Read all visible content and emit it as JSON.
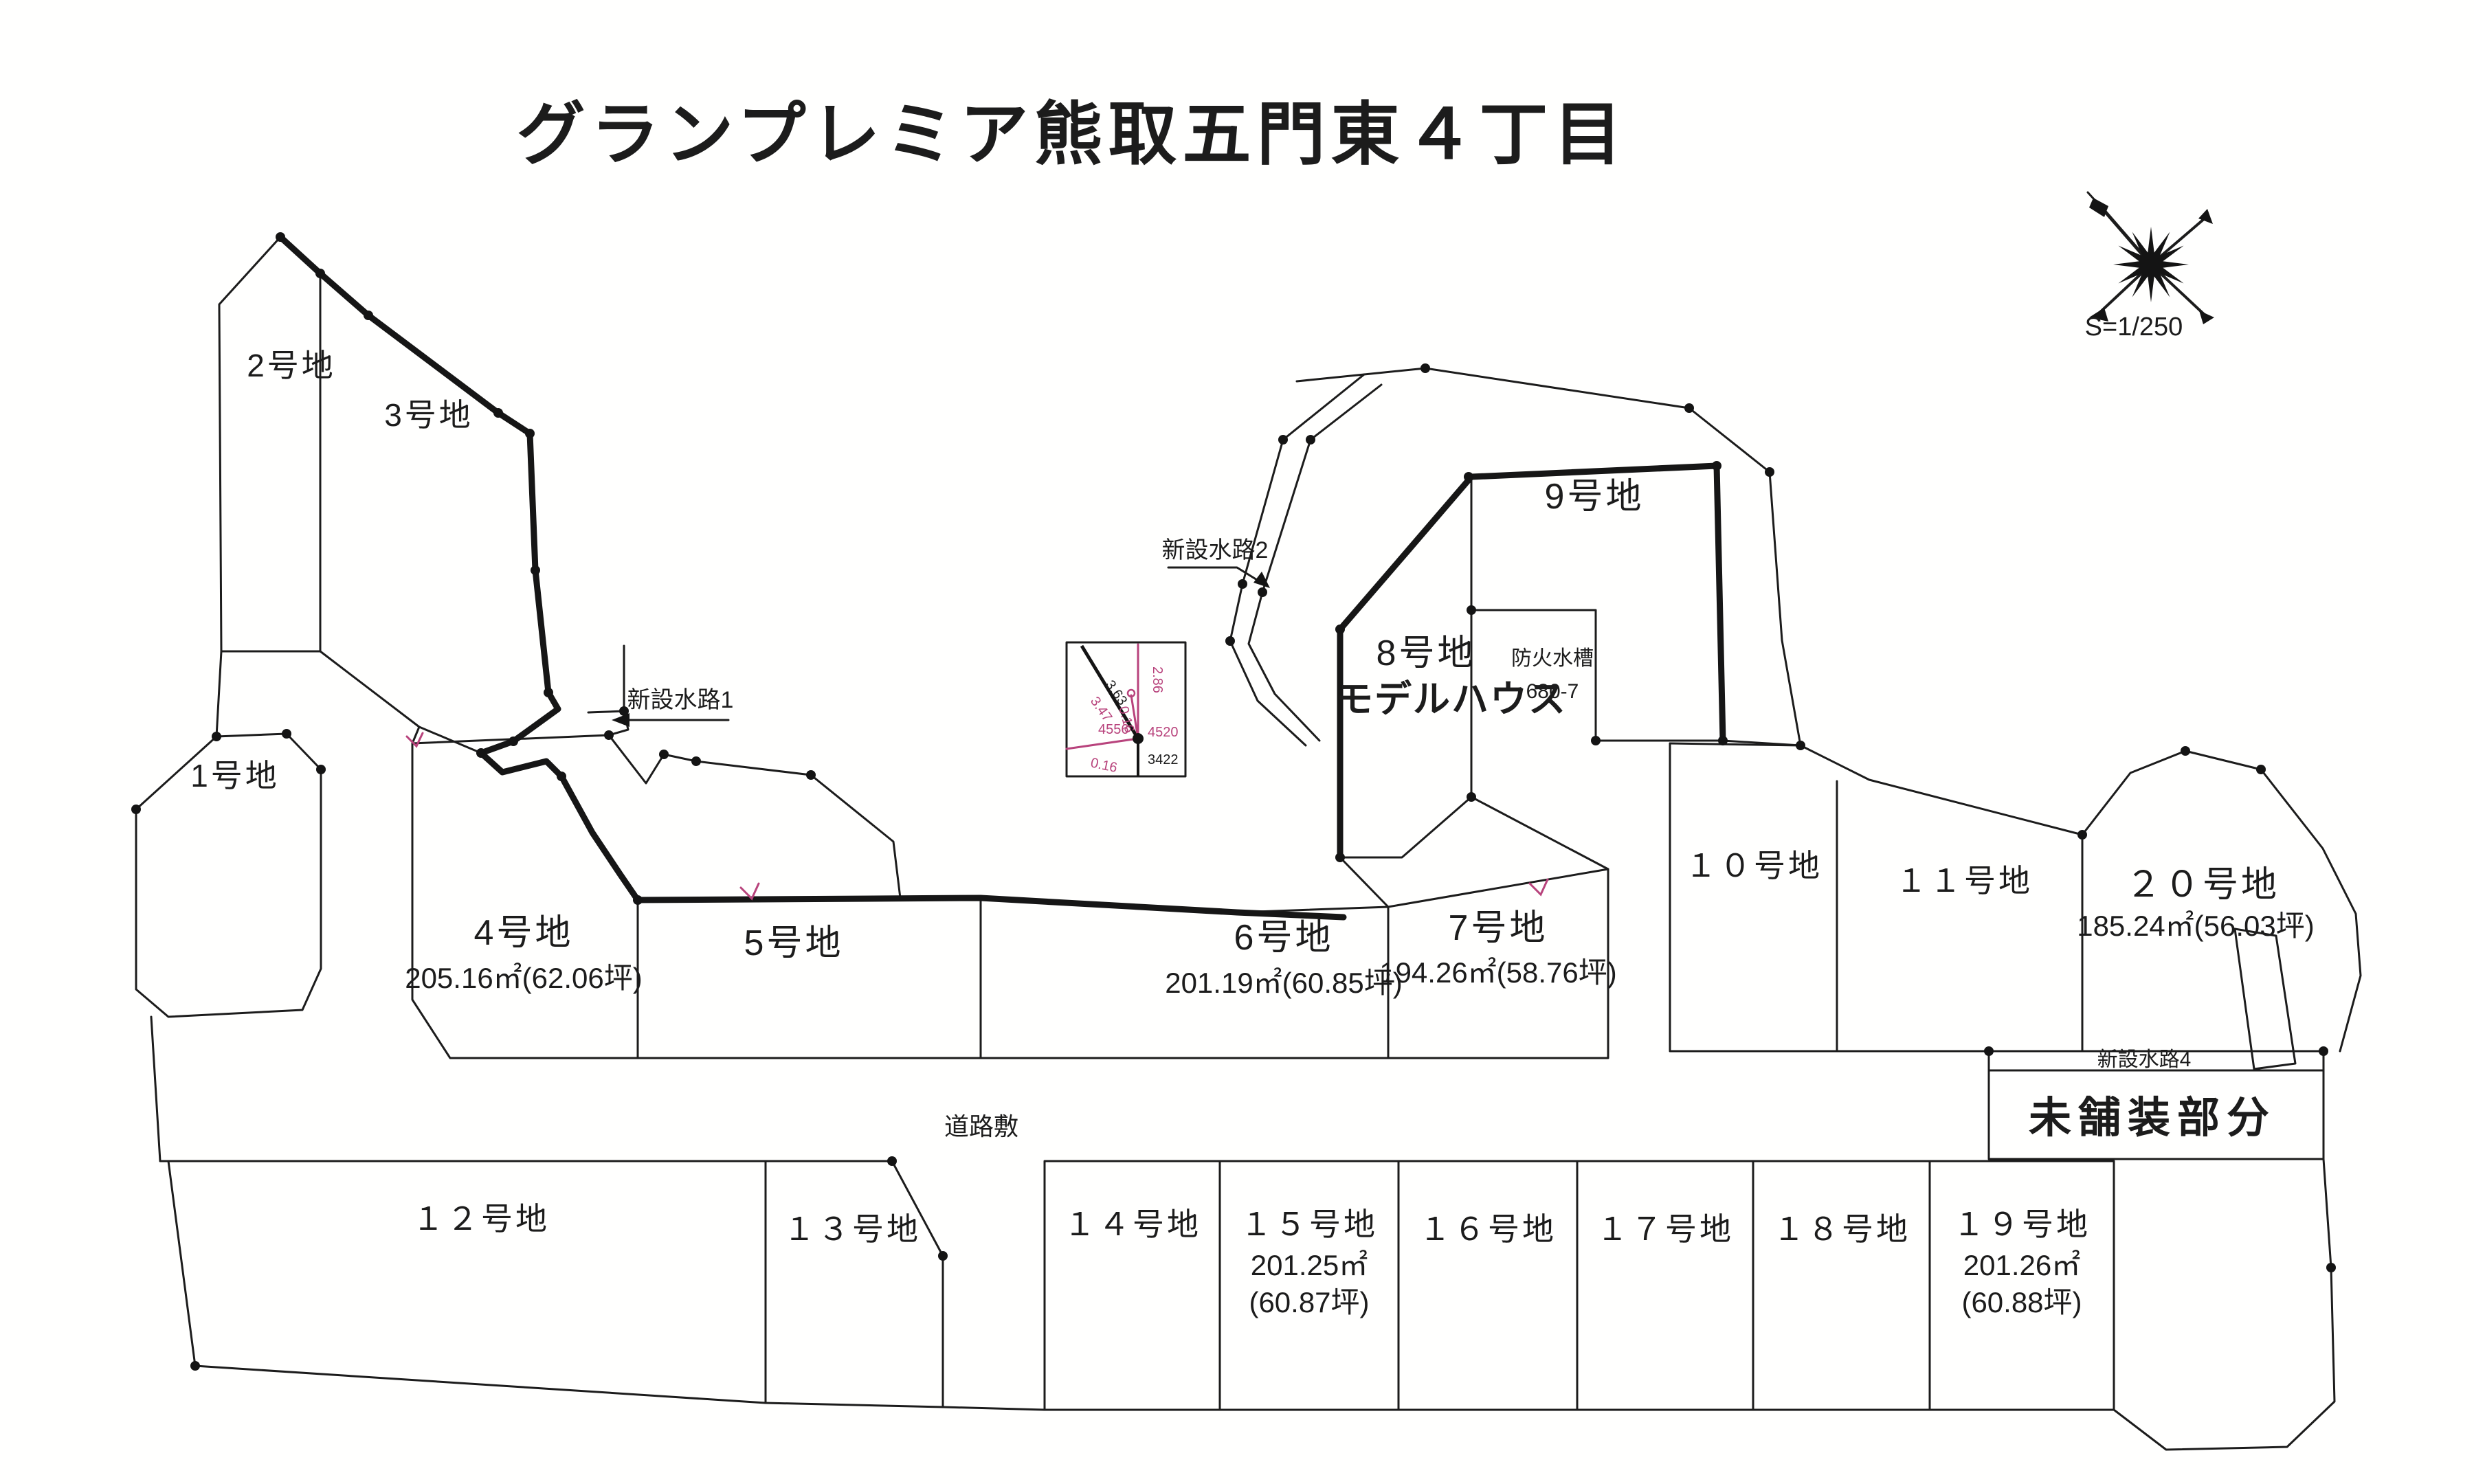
{
  "title": {
    "text": "グランプレミア熊取五門東４丁目"
  },
  "colors": {
    "accent_magenta": "#a8437c",
    "accent_red": "#c05568",
    "line": "#1c1c1c"
  },
  "compass": {
    "scale_label": "S=1/250"
  },
  "lots": [
    {
      "id": "1",
      "label": "1号地"
    },
    {
      "id": "2",
      "label": "2号地"
    },
    {
      "id": "3",
      "label": "3号地"
    },
    {
      "id": "4",
      "label": "4号地",
      "area": "205.16㎡(62.06坪)"
    },
    {
      "id": "5",
      "label": "5号地"
    },
    {
      "id": "6",
      "label": "6号地",
      "area": "201.19㎡(60.85坪)"
    },
    {
      "id": "7",
      "label": "7号地",
      "area": "194.26㎡(58.76坪)"
    },
    {
      "id": "8",
      "label": "8号地",
      "note": "モデルハウス"
    },
    {
      "id": "9",
      "label": "9号地"
    },
    {
      "id": "10",
      "label": "１０号地"
    },
    {
      "id": "11",
      "label": "１１号地"
    },
    {
      "id": "12",
      "label": "１２号地"
    },
    {
      "id": "13",
      "label": "１３号地"
    },
    {
      "id": "14",
      "label": "１４号地"
    },
    {
      "id": "15",
      "label": "１５号地",
      "area": "201.25㎡",
      "tsubo": "(60.87坪)"
    },
    {
      "id": "16",
      "label": "１６号地"
    },
    {
      "id": "17",
      "label": "１７号地"
    },
    {
      "id": "18",
      "label": "１８号地"
    },
    {
      "id": "19",
      "label": "１９号地",
      "area": "201.26㎡",
      "tsubo": "(60.88坪)"
    },
    {
      "id": "20",
      "label": "２０号地",
      "area": "185.24㎡(56.03坪)"
    }
  ],
  "annotations": {
    "waterway1": "新設水路1",
    "waterway2": "新設水路2",
    "waterway4": "新設水路4",
    "unpaved": "未舗装部分",
    "road": "道路敷",
    "fire_tank_line1": "防火水槽",
    "fire_tank_line2": "680-7"
  },
  "inset": {
    "d363": "3.63",
    "d347": "3.47",
    "d286": "2.86",
    "d016a": "0.16",
    "d016b": "0.16",
    "n4556": "4556",
    "n4520": "4520",
    "n3422": "3422"
  }
}
